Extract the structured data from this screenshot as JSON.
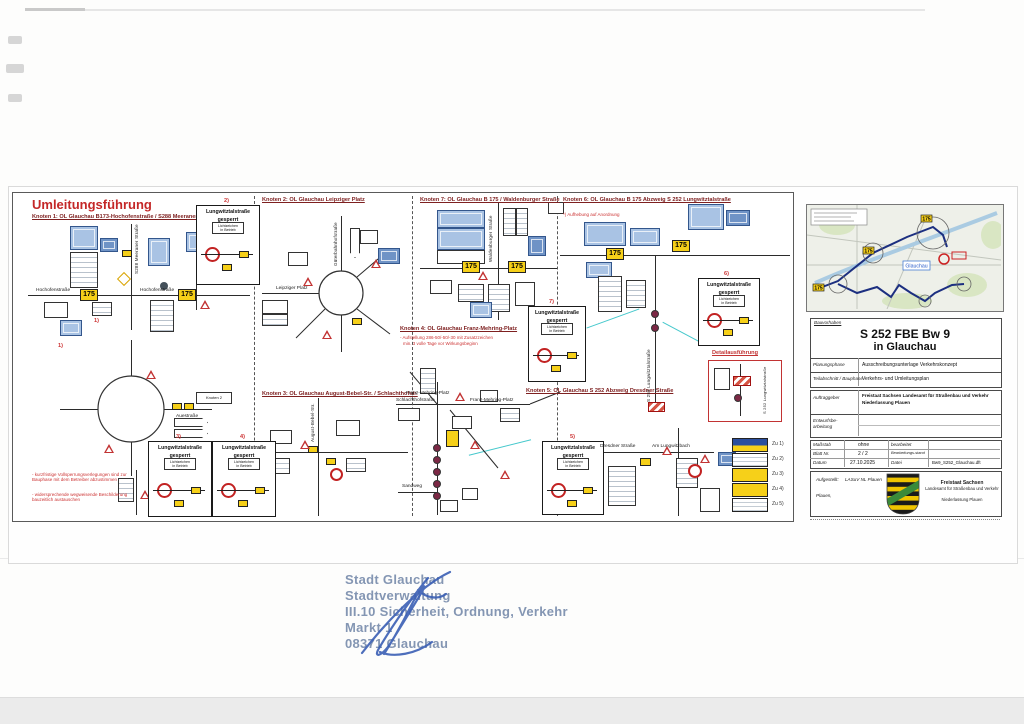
{
  "sheet": {
    "title": "Umleitungsführung",
    "footnote1": "- kurzfristige Vollsperrungsverlegungen sind zur Bauphase mit dem Betreiber abzustimmen",
    "footnote2": "- widersprechende wegweisende Beschilderung bauzeitlich austauschen"
  },
  "knoten": {
    "k1": "Knoten 1: OL Glauchau B173-Hochofenstraße / S288 Meeraner Str.",
    "k2": "Knoten 2: OL Glauchau Leipziger Platz",
    "k3": "Knoten 3: OL Glauchau August-Bebel-Str. / Schlachthofstr.",
    "k4": "Knoten 4: OL Glauchau Franz-Mehring-Platz",
    "k4_note1": "- Aufstellung 286-50/-50/-30 mit Zusatzzeichen",
    "k4_note2": "min. 3 volle Tage vor Wirkungsbeginn",
    "k5": "Knoten 5: OL Glauchau S 252 Abzweig Dresdner Straße",
    "k6": "Knoten 6: OL Glauchau B 175 Abzweig S 252 Lungwitztalstraße",
    "k6_note": "*) Aufhebung auf Anordnung",
    "k7": "Knoten 7: OL Glauchau B 175 / Waldenburger Straße"
  },
  "closure": {
    "line1": "Lungwitztalstraße",
    "line2": "gesperrt",
    "sub1": "Lichtzeichen",
    "sub2": "in Betrieb",
    "refs": {
      "r1": "1)",
      "r2": "2)",
      "r3": "3)",
      "r4": "4)",
      "r5": "5)",
      "r6": "6)",
      "r7": "7)"
    }
  },
  "shield": {
    "b175": "175"
  },
  "streets": {
    "hochofen": "Hochofenstraße",
    "meeraner": "S288 Meeraner Straße",
    "aue": "Auestraße",
    "leipziger": "Leipziger Platz",
    "gueterbahnhof": "Güterbahnhofstraße",
    "august_bebel": "August-Bebel-Str.",
    "waldenburger": "Waldenburger Straße",
    "franz_mehring": "Franz-Mehring-Platz",
    "schlachthof": "Schlachthofstraße",
    "sandweg": "Sandweg",
    "dresdner": "Dresdner Straße",
    "lungwitzbach": "Am Lungwitzbach",
    "lungwitztal": "S 252 Lungwitztalstraße",
    "knoten2_ptr": "Knoten 2"
  },
  "detail": {
    "label": "Detailausführung"
  },
  "legend": {
    "z1": "Zu 1)",
    "z2": "Zu 2)",
    "z3": "Zu 3)",
    "z4": "Zu 4)",
    "z5": "Zu 5)"
  },
  "overview_map": {
    "town": "Glauchau"
  },
  "titleblock": {
    "bauvorhaben_label": "Bauvorhaben",
    "project_line1": "S 252 FBE Bw 9",
    "project_line2": "in Glauchau",
    "planungsphase_label": "Planungsphase",
    "planungsphase_value": "Ausschreibungsunterlage Verkehrskonzept",
    "teilabschnitt_label": "Teilabschnitt / Bauphase",
    "teilabschnitt_value": "Verkehrs- und Umleitungsplan",
    "auftraggeber_label": "Auftraggeber",
    "auftraggeber_value1": "Freistaat Sachsen Landesamt für Straßenbau und Verkehr",
    "auftraggeber_value2": "Niederlassung Plauen",
    "entwurf_label1": "Entwurfsbe-",
    "entwurf_label2": "arbeitung",
    "masstab_label": "Maßstab",
    "masstab_value": "ohne",
    "bearbeitet_label": "bearbeitet",
    "blatt_label": "Blatt Nr.",
    "blatt_value": "2 / 2",
    "stand_label": "Bearbeitungs-stand",
    "datum_label": "Datum",
    "datum_value": "27.10.2025",
    "datei_label": "Datei",
    "datei_value": "Bw9_S252_Glauchau.dft",
    "aufgestellt_label": "Aufgestellt:",
    "org": "LASuV NL Plauen",
    "place": "Plauen,",
    "agency_line1": "Freistaat Sachsen",
    "agency_line2": "Landesamt für Straßenbau und Verkehr",
    "agency_line3": "Niederlassung Plauen"
  },
  "stamp": {
    "line1": "Stadt Glauchau",
    "line2": "Stadtverwaltung",
    "line3": "III.10 Sicherheit, Ordnung, Verkehr",
    "line4": "Markt 1",
    "line5": "08371 Glauchau"
  }
}
